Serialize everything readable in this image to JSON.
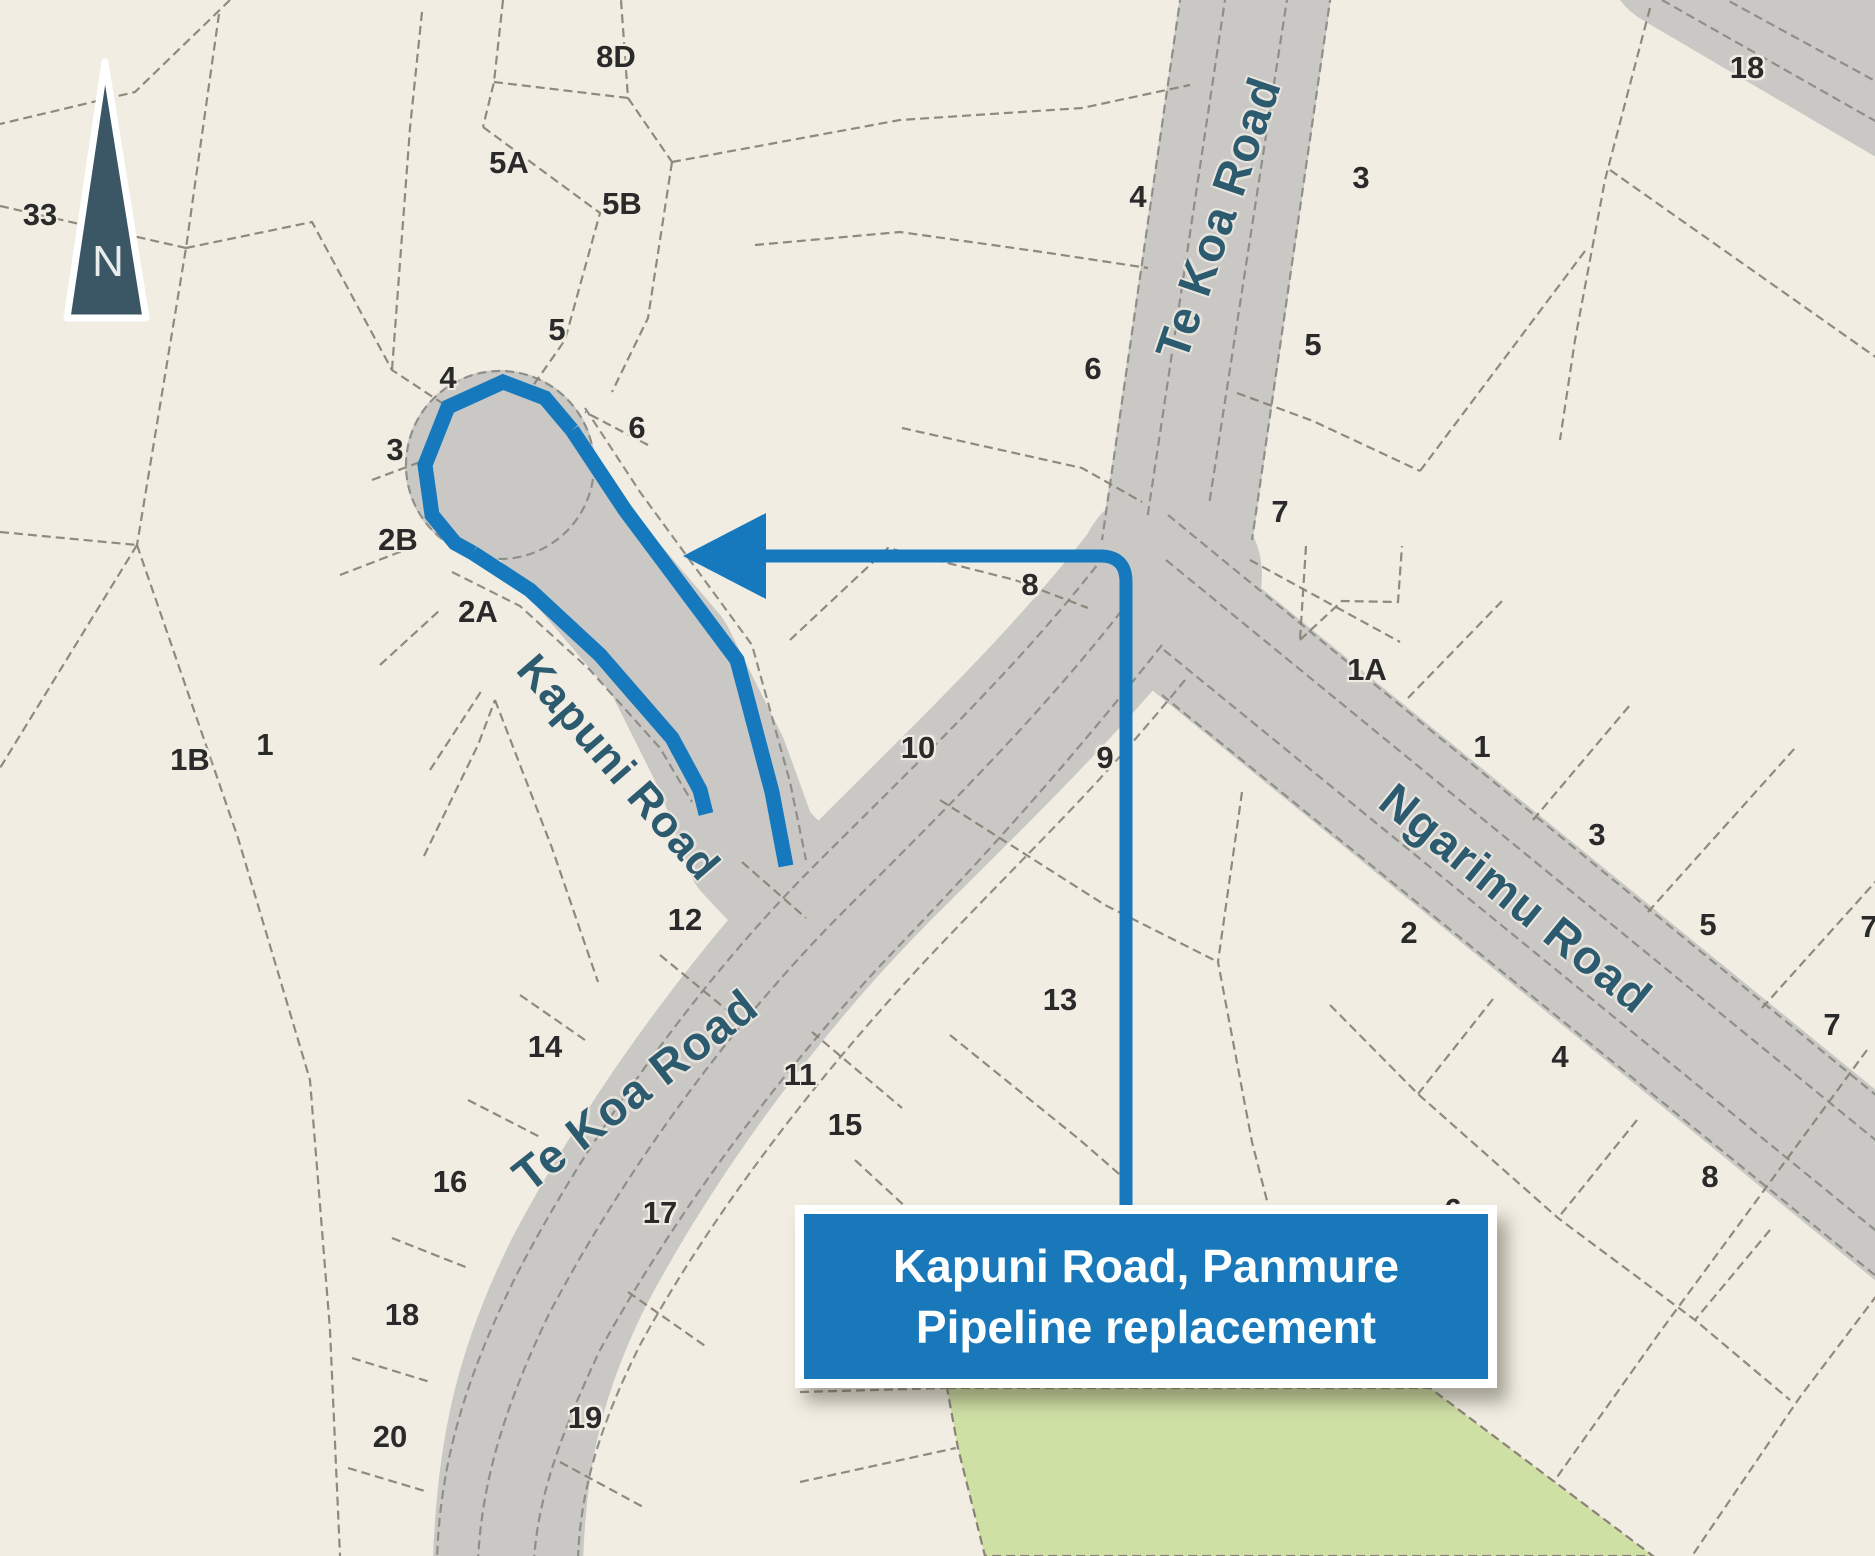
{
  "map": {
    "title_box": {
      "line1": "Kapuni Road, Panmure",
      "line2": "Pipeline replacement"
    },
    "north_arrow_label": "N",
    "colors": {
      "background": "#f1ede3",
      "road_gray": "#c9c8c5",
      "highlight_blue": "#1679bd",
      "title_box_blue": "#1878ba",
      "reserve_green": "#cfe0a5",
      "parcel_dash": "#8a8476",
      "number_text": "#2a2a2a",
      "road_name_text": "#2c5a6f"
    },
    "road_labels": [
      {
        "text": "Te Koa Road",
        "x": 1218,
        "y": 218,
        "rotate": -71,
        "size": 47
      },
      {
        "text": "Kapuni Road",
        "x": 618,
        "y": 768,
        "rotate": 49,
        "size": 44
      },
      {
        "text": "Te Koa Road",
        "x": 635,
        "y": 1090,
        "rotate": -38,
        "size": 47
      },
      {
        "text": "Ngarimu Road",
        "x": 1516,
        "y": 898,
        "rotate": 39,
        "size": 47
      }
    ],
    "lot_numbers": [
      {
        "text": "33",
        "x": 40,
        "y": 215
      },
      {
        "text": "8D",
        "x": 616,
        "y": 57
      },
      {
        "text": "5A",
        "x": 509,
        "y": 163
      },
      {
        "text": "5B",
        "x": 622,
        "y": 204
      },
      {
        "text": "5",
        "x": 557,
        "y": 330
      },
      {
        "text": "4",
        "x": 448,
        "y": 378
      },
      {
        "text": "3",
        "x": 395,
        "y": 450
      },
      {
        "text": "2B",
        "x": 398,
        "y": 540
      },
      {
        "text": "2A",
        "x": 478,
        "y": 612
      },
      {
        "text": "6",
        "x": 637,
        "y": 428
      },
      {
        "text": "1B",
        "x": 190,
        "y": 760
      },
      {
        "text": "1",
        "x": 265,
        "y": 745
      },
      {
        "text": "4",
        "x": 1138,
        "y": 197
      },
      {
        "text": "6",
        "x": 1093,
        "y": 369
      },
      {
        "text": "3",
        "x": 1361,
        "y": 178
      },
      {
        "text": "5",
        "x": 1313,
        "y": 345
      },
      {
        "text": "7",
        "x": 1280,
        "y": 512
      },
      {
        "text": "8",
        "x": 1030,
        "y": 585
      },
      {
        "text": "10",
        "x": 918,
        "y": 748
      },
      {
        "text": "9",
        "x": 1105,
        "y": 758
      },
      {
        "text": "12",
        "x": 685,
        "y": 920
      },
      {
        "text": "14",
        "x": 545,
        "y": 1047
      },
      {
        "text": "11",
        "x": 800,
        "y": 1075
      },
      {
        "text": "15",
        "x": 845,
        "y": 1125
      },
      {
        "text": "13",
        "x": 1060,
        "y": 1000
      },
      {
        "text": "16",
        "x": 450,
        "y": 1182
      },
      {
        "text": "17",
        "x": 660,
        "y": 1213
      },
      {
        "text": "18",
        "x": 402,
        "y": 1315
      },
      {
        "text": "19",
        "x": 585,
        "y": 1418
      },
      {
        "text": "20",
        "x": 390,
        "y": 1437
      },
      {
        "text": "1A",
        "x": 1367,
        "y": 670
      },
      {
        "text": "1",
        "x": 1482,
        "y": 747
      },
      {
        "text": "2",
        "x": 1409,
        "y": 933
      },
      {
        "text": "3",
        "x": 1597,
        "y": 835
      },
      {
        "text": "5",
        "x": 1708,
        "y": 925
      },
      {
        "text": "7",
        "x": 1832,
        "y": 1025
      },
      {
        "text": "7",
        "x": 1869,
        "y": 927
      },
      {
        "text": "4",
        "x": 1560,
        "y": 1057
      },
      {
        "text": "8",
        "x": 1710,
        "y": 1177
      },
      {
        "text": "6",
        "x": 1453,
        "y": 1210
      },
      {
        "text": "18",
        "x": 1747,
        "y": 68
      }
    ]
  }
}
